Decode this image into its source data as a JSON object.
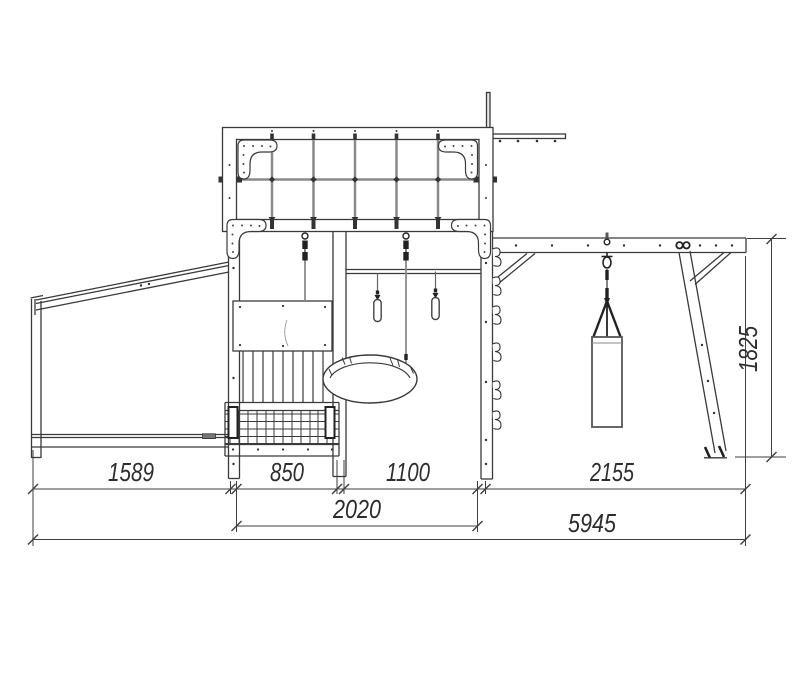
{
  "drawing": {
    "type": "side elevation blueprint",
    "subject": "kids playground complex",
    "units": "mm",
    "dims": {
      "left_bay": "1589",
      "front_bay": "850",
      "swing_bay": "1100",
      "bag_bay": "2155",
      "tower": "2020",
      "overall": "5945",
      "beam_height": "1825"
    },
    "colors": {
      "background": "#ffffff",
      "line": "#3a3a3a",
      "rope": "#8a8a8a",
      "dim_text": "#2d2d2d"
    }
  }
}
